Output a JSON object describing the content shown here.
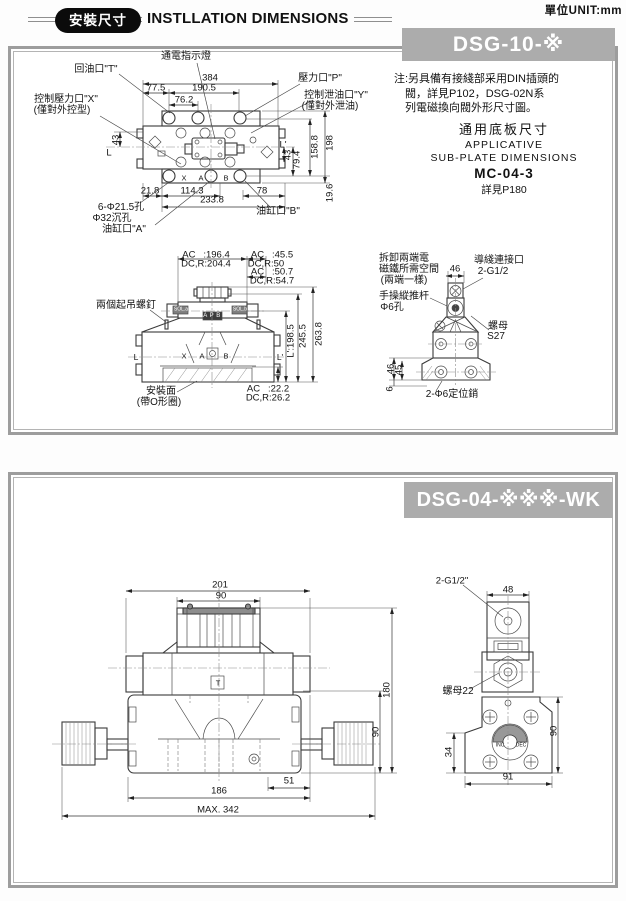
{
  "page": {
    "unit": "單位UNIT:mm",
    "badge": "安裝尺寸",
    "title": "INSTLLATION DIMENSIONS"
  },
  "panel1": {
    "banner": "DSG-10-※",
    "note": {
      "l1": "注:另具備有接綫部采用DIN插頭的",
      "l2": "閥，詳見P102，DSG-02N系",
      "l3": "列電磁換向閥外形尺寸圖。",
      "sub_cn": "通用底板尺寸",
      "sub_en1": "APPLICATIVE",
      "sub_en2": "SUB-PLATE DIMENSIONS",
      "model": "MC-04-3",
      "see": "詳見P180"
    },
    "labels": [
      {
        "t": "通電指示燈",
        "x": 186,
        "y": 57,
        "cls": "cn"
      },
      {
        "t": "回油口\"T\"",
        "x": 96,
        "y": 70,
        "cls": "cn"
      },
      {
        "t": "壓力口\"P\"",
        "x": 320,
        "y": 79,
        "cls": "cn"
      },
      {
        "t": "控制泄油口\"Y\"",
        "x": 336,
        "y": 96,
        "cls": "cn"
      },
      {
        "t": "(僅對外泄油)",
        "x": 330,
        "y": 107,
        "cls": "cn"
      },
      {
        "t": "控制壓力口\"X\"",
        "x": 66,
        "y": 100,
        "cls": "cn"
      },
      {
        "t": "(僅對外控型)",
        "x": 62,
        "y": 111,
        "cls": "cn"
      },
      {
        "t": "384",
        "x": 210,
        "y": 78
      },
      {
        "t": "77.5",
        "x": 156,
        "y": 88
      },
      {
        "t": "190.5",
        "x": 204,
        "y": 88
      },
      {
        "t": "76.2",
        "x": 184,
        "y": 100
      },
      {
        "t": "43",
        "x": 116,
        "y": 140,
        "r": -90
      },
      {
        "t": "L",
        "x": 109,
        "y": 153
      },
      {
        "t": "L'",
        "x": 283,
        "y": 145
      },
      {
        "t": "43",
        "x": 288,
        "y": 155,
        "r": -90
      },
      {
        "t": "79.4",
        "x": 297,
        "y": 160,
        "r": -90
      },
      {
        "t": "158.8",
        "x": 315,
        "y": 147,
        "r": -90
      },
      {
        "t": "198",
        "x": 330,
        "y": 143,
        "r": -90
      },
      {
        "t": "19.6",
        "x": 330,
        "y": 193,
        "r": -90
      },
      {
        "t": "21.8",
        "x": 150,
        "y": 191
      },
      {
        "t": "114.3",
        "x": 192,
        "y": 191
      },
      {
        "t": "78",
        "x": 262,
        "y": 191
      },
      {
        "t": "233.8",
        "x": 212,
        "y": 200
      },
      {
        "t": "6-Φ21.5孔",
        "x": 121,
        "y": 208,
        "cls": "cn"
      },
      {
        "t": "Φ32沉孔",
        "x": 112,
        "y": 219,
        "cls": "cn"
      },
      {
        "t": "油缸口\"A\"",
        "x": 124,
        "y": 230,
        "cls": "cn"
      },
      {
        "t": "油缸口\"B\"",
        "x": 278,
        "y": 212,
        "cls": "cn"
      },
      {
        "t": "X",
        "x": 184,
        "y": 178,
        "cls": "t7"
      },
      {
        "t": "A",
        "x": 201,
        "y": 178,
        "cls": "t7"
      },
      {
        "t": "B",
        "x": 226,
        "y": 178,
        "cls": "t7"
      },
      {
        "t": "AC   :196.4",
        "x": 206,
        "y": 255
      },
      {
        "t": "DC,R:204.4",
        "x": 206,
        "y": 264
      },
      {
        "t": "AC   :45.5",
        "x": 272,
        "y": 255
      },
      {
        "t": "DC,R:50",
        "x": 266,
        "y": 264
      },
      {
        "t": "AC   :50.7",
        "x": 272,
        "y": 272
      },
      {
        "t": "DC,R:54.7",
        "x": 272,
        "y": 281
      },
      {
        "t": "兩個起吊螺釘",
        "x": 126,
        "y": 306,
        "cls": "cn"
      },
      {
        "t": "SOL.a",
        "x": 181,
        "y": 310,
        "cls": "t5 wt"
      },
      {
        "t": "SOL.b",
        "x": 240,
        "y": 310,
        "cls": "t5 wt"
      },
      {
        "t": "A P B",
        "x": 212,
        "y": 316,
        "cls": "t6 wt"
      },
      {
        "t": "L",
        "x": 136,
        "y": 357,
        "cls": "t8"
      },
      {
        "t": "X",
        "x": 184,
        "y": 356,
        "cls": "t7"
      },
      {
        "t": "A",
        "x": 202,
        "y": 356,
        "cls": "t7"
      },
      {
        "t": "B",
        "x": 226,
        "y": 356,
        "cls": "t7"
      },
      {
        "t": "L'",
        "x": 280,
        "y": 357,
        "cls": "t8"
      },
      {
        "t": "L':198.5",
        "x": 291,
        "y": 341,
        "r": -90
      },
      {
        "t": "245.5",
        "x": 303,
        "y": 336,
        "r": -90
      },
      {
        "t": "263.8",
        "x": 319,
        "y": 334,
        "r": -90
      },
      {
        "t": "安裝面",
        "x": 161,
        "y": 392,
        "cls": "cn"
      },
      {
        "t": "(帶O形圈)",
        "x": 159,
        "y": 403,
        "cls": "cn"
      },
      {
        "t": "AC   :22.2",
        "x": 268,
        "y": 389
      },
      {
        "t": "DC,R:26.2",
        "x": 268,
        "y": 398
      },
      {
        "t": "拆卸兩端電",
        "x": 404,
        "y": 259,
        "cls": "cn"
      },
      {
        "t": "磁鐵所需空間",
        "x": 409,
        "y": 270,
        "cls": "cn"
      },
      {
        "t": "(兩端一樣)",
        "x": 404,
        "y": 281,
        "cls": "cn"
      },
      {
        "t": "46",
        "x": 455,
        "y": 269
      },
      {
        "t": "導綫連接口",
        "x": 499,
        "y": 261,
        "cls": "cn"
      },
      {
        "t": "2-G1/2",
        "x": 493,
        "y": 272,
        "cls": "cn"
      },
      {
        "t": "手操縱推杆",
        "x": 404,
        "y": 297,
        "cls": "cn"
      },
      {
        "t": "Φ6孔",
        "x": 392,
        "y": 308,
        "cls": "cn"
      },
      {
        "t": "螺母",
        "x": 498,
        "y": 327,
        "cls": "cn"
      },
      {
        "t": "S27",
        "x": 496,
        "y": 337,
        "cls": "cn"
      },
      {
        "t": "46",
        "x": 391,
        "y": 369,
        "r": -90
      },
      {
        "t": "45",
        "x": 399,
        "y": 370,
        "r": -90
      },
      {
        "t": "6",
        "x": 390,
        "y": 389,
        "r": -90
      },
      {
        "t": "2-Φ6定位銷",
        "x": 452,
        "y": 395,
        "cls": "cn"
      }
    ]
  },
  "panel2": {
    "banner": "DSG-04-※※※-WK",
    "labels": [
      {
        "t": "201",
        "x": 220,
        "y": 585
      },
      {
        "t": "90",
        "x": 221,
        "y": 596
      },
      {
        "t": "T",
        "x": 218,
        "y": 683,
        "cls": "t7"
      },
      {
        "t": "180",
        "x": 387,
        "y": 690,
        "r": -90
      },
      {
        "t": "90",
        "x": 376,
        "y": 732,
        "r": -90
      },
      {
        "t": "51",
        "x": 289,
        "y": 781
      },
      {
        "t": "186",
        "x": 219,
        "y": 791
      },
      {
        "t": "MAX. 342",
        "x": 218,
        "y": 810
      },
      {
        "t": "2-G1/2\"",
        "x": 452,
        "y": 581
      },
      {
        "t": "48",
        "x": 508,
        "y": 590
      },
      {
        "t": "螺母22",
        "x": 458,
        "y": 692,
        "cls": "cn"
      },
      {
        "t": "90",
        "x": 554,
        "y": 731,
        "r": -90
      },
      {
        "t": "34",
        "x": 449,
        "y": 752,
        "r": -90
      },
      {
        "t": "91",
        "x": 508,
        "y": 777
      },
      {
        "t": "INC",
        "x": 500,
        "y": 746,
        "cls": "t5"
      },
      {
        "t": "DEC",
        "x": 521,
        "y": 746,
        "cls": "t5"
      }
    ]
  }
}
